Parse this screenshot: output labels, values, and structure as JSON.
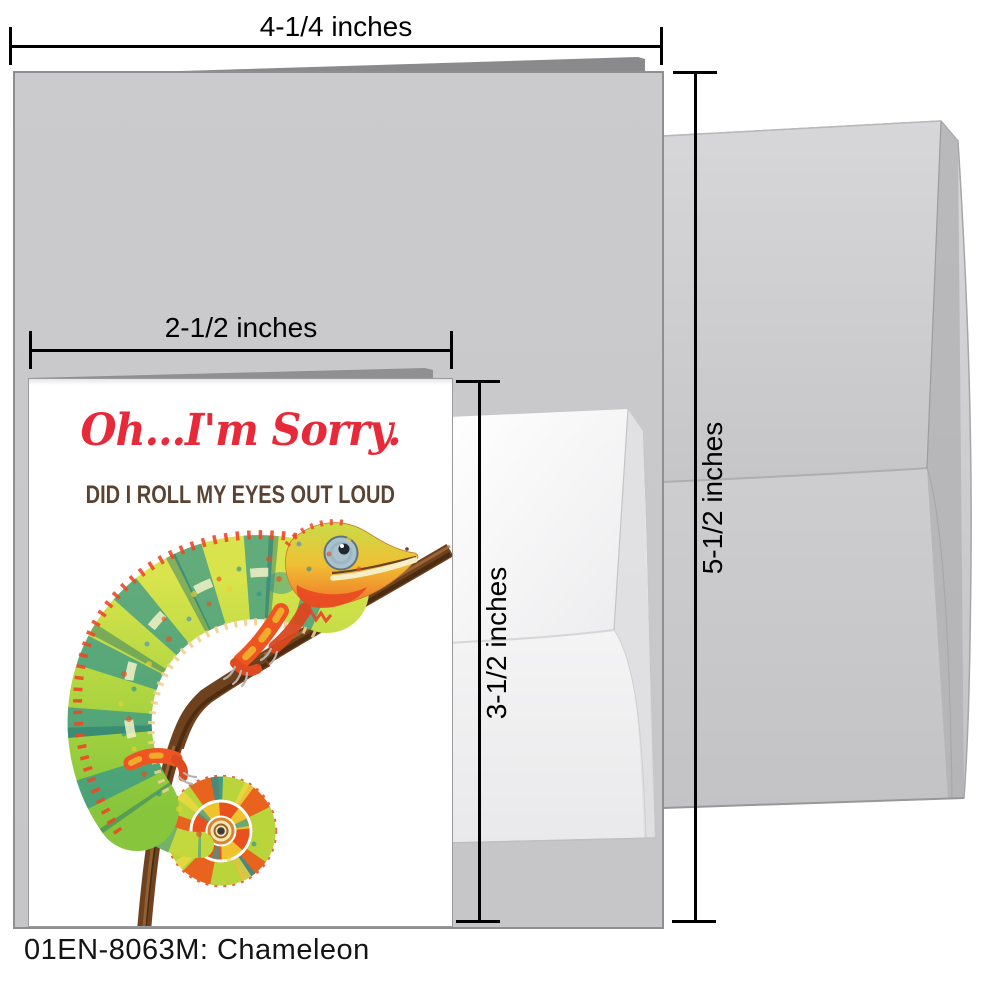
{
  "product": {
    "caption": "01EN-8063M: Chameleon"
  },
  "card": {
    "title": "Oh...I'm Sorry.",
    "subtitle": "DID I ROLL MY EYES OUT LOUD",
    "artwork": "chameleon-on-branch-watercolor"
  },
  "measurements": {
    "large_card_width": "4-1/4 inches",
    "envelope_height": "5-1/2 inches",
    "small_card_width": "2-1/2 inches",
    "small_card_height": "3-1/2 inches"
  },
  "colors": {
    "title_red": "#e8293a",
    "subtitle_brown": "#5a4332",
    "card_gray": "#c9c9cb",
    "envelope_gray": "#d2d2d4",
    "branch_brown": "#6f421f",
    "body_green": "#9ecf3e",
    "stripe_teal": "#2f9390",
    "accent_orange": "#ee5522"
  }
}
